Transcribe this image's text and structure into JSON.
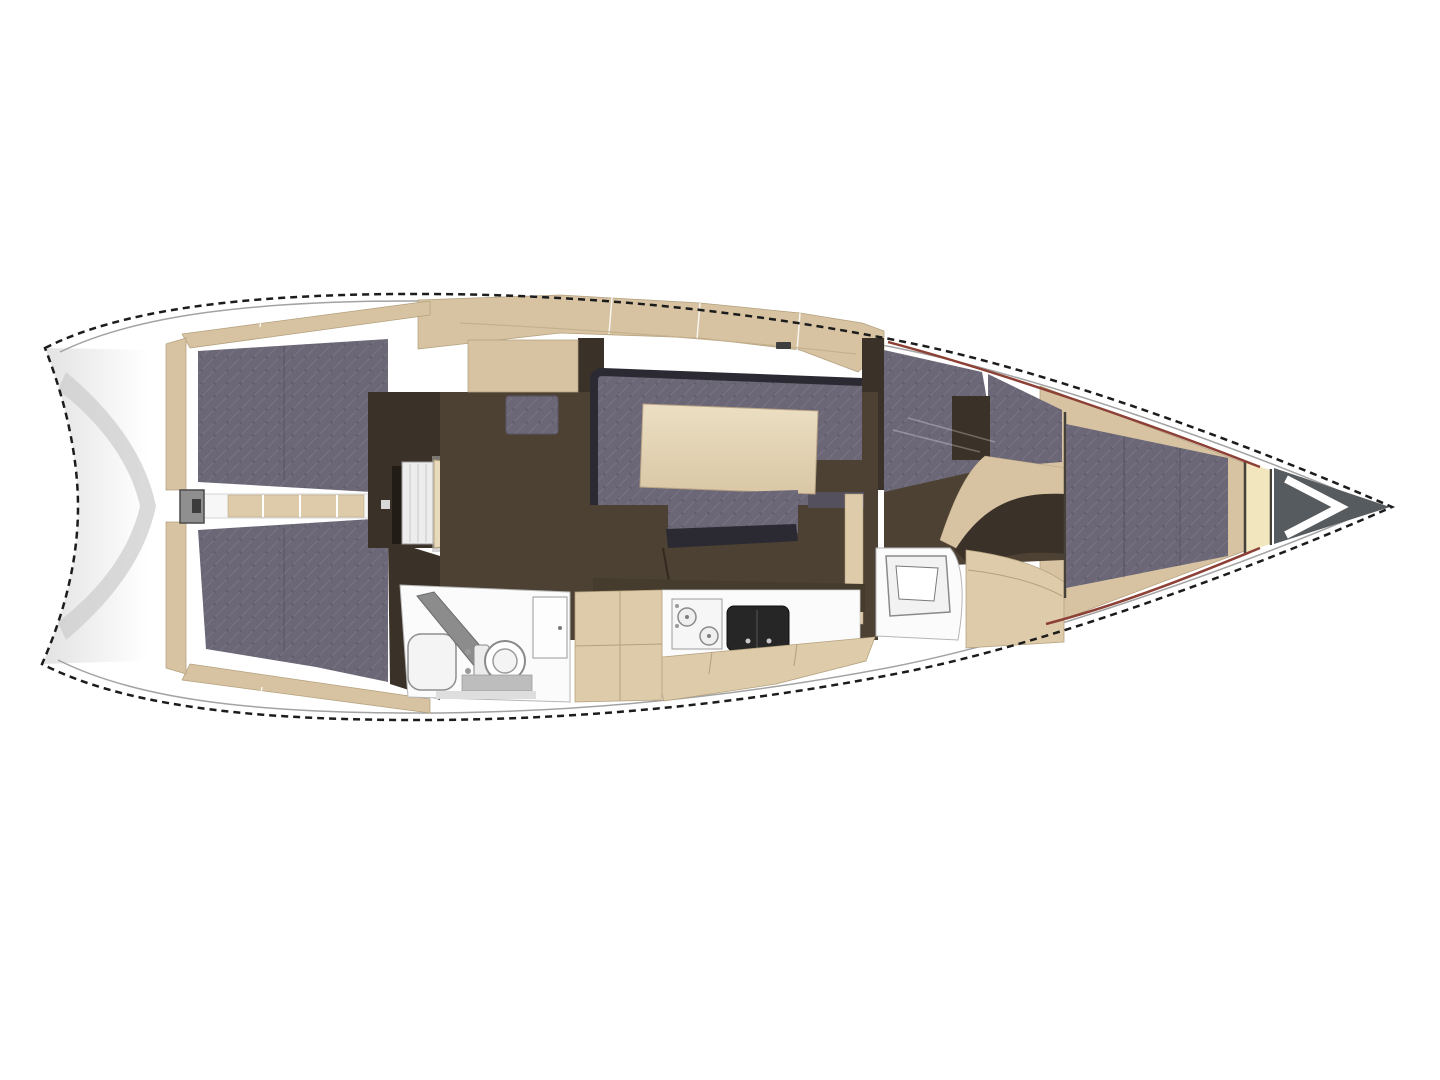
{
  "meta": {
    "title": "Sailing yacht interior layout plan",
    "figure_type": "boat-floor-plan",
    "view": "top-down",
    "bow_direction": "right"
  },
  "palette": {
    "background": "#ffffff",
    "hull_white": "#ffffff",
    "outline_dark": "#1c1c1c",
    "inner_line_gray": "#a3a3a3",
    "transom_shade": "#cdcdcd",
    "transom_grad_start": "#e2e2e2",
    "wood_beige": "#d7c3a2",
    "wood_beige_light": "#decbaa",
    "wood_edge": "#b3a07d",
    "step_cream": "#e9dabb",
    "table_light": "#ecdfc3",
    "table_dark": "#d9c7a5",
    "upholstery_gray": "#6c6777",
    "dark_trim": "#2b2a33",
    "floor_brown": "#4c4133",
    "furniture_brown": "#3a3128",
    "galley_front": "#463c2e",
    "room_white": "#fbfbfb",
    "fixture_gray": "#8f8f8f",
    "sink_black": "#262626",
    "cream_shelf": "#f1e6bd",
    "anchor_gray": "#565b5f",
    "chevron_white": "#ffffff",
    "accent_red": "#8d4035"
  },
  "components": [
    {
      "name": "transom-swim-platform",
      "label": "Transom / swim platform"
    },
    {
      "name": "cockpit-bench-port",
      "label": "Cockpit bench (port)"
    },
    {
      "name": "cockpit-bench-starboard",
      "label": "Cockpit bench (starboard)"
    },
    {
      "name": "cockpit-walkway",
      "label": "Cockpit walkway"
    },
    {
      "name": "transom-gate",
      "label": "Transom gate"
    },
    {
      "name": "companionway-hatch",
      "label": "Companionway hatch"
    },
    {
      "name": "companionway-steps",
      "label": "Companionway steps"
    },
    {
      "name": "nav-station",
      "label": "Navigation station"
    },
    {
      "name": "saloon-settee",
      "label": "Saloon settee"
    },
    {
      "name": "saloon-table",
      "label": "Saloon table"
    },
    {
      "name": "saloon-ottoman",
      "label": "Saloon ottoman"
    },
    {
      "name": "galley",
      "label": "Galley with stove and sink"
    },
    {
      "name": "aft-head",
      "label": "Aft head with toilet and shower"
    },
    {
      "name": "wardrobe",
      "label": "Wardrobe"
    },
    {
      "name": "forward-berth",
      "label": "Forward cabin berth"
    },
    {
      "name": "forward-head",
      "label": "Forward head with washbasin"
    },
    {
      "name": "v-berth",
      "label": "V-berth"
    },
    {
      "name": "bow-shelf",
      "label": "Bow shelf"
    },
    {
      "name": "anchor-locker",
      "label": "Anchor locker"
    }
  ]
}
